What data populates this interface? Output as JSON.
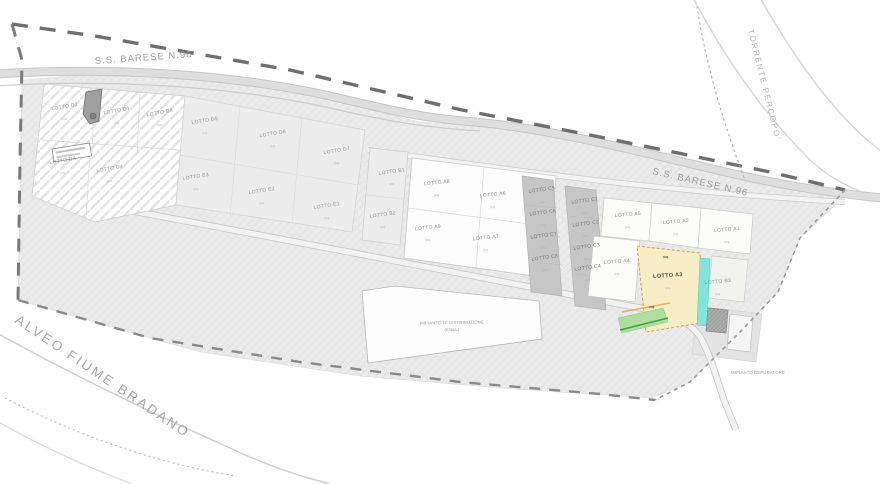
{
  "roads": {
    "ss_barese": "S.S. BARESE N.96"
  },
  "waterways": {
    "torrente": "TORRENTE PERCOPO'",
    "alveo": "ALVEO FIUME BRADANO"
  },
  "facilities": {
    "distribuzione_line1": "IMPIANTO DI DISTRIBUZIONE",
    "distribuzione_line2": "(ENEL)",
    "depuratore": "IMPIANTO DEPURATORE"
  },
  "area_unit": "mq.",
  "colors": {
    "highlight_fill": "#f6edc6",
    "highlight_border": "#c9a84c",
    "teal_strip": "#82e4dc",
    "green_area": "#aede9e",
    "green_line": "#3f9e3f",
    "orange_line": "#e0b75c"
  },
  "lots": [
    {
      "label": "LOTTO D2",
      "x": 65,
      "y": 108,
      "r": -10
    },
    {
      "label": "LOTTO D1",
      "x": 117,
      "y": 112,
      "r": -10
    },
    {
      "label": "LOTTO D8",
      "x": 160,
      "y": 114,
      "r": -10
    },
    {
      "label": "LOTTO D3",
      "x": 63,
      "y": 162,
      "r": -10
    },
    {
      "label": "LOTTO D4",
      "x": 110,
      "y": 170,
      "r": -10
    },
    {
      "label": "LOTTO D5",
      "x": 205,
      "y": 122,
      "r": -9
    },
    {
      "label": "LOTTO D6",
      "x": 273,
      "y": 135,
      "r": -9
    },
    {
      "label": "LOTTO D7",
      "x": 337,
      "y": 152,
      "r": -9
    },
    {
      "label": "LOTTO E3",
      "x": 196,
      "y": 178,
      "r": -9
    },
    {
      "label": "LOTTO E2",
      "x": 262,
      "y": 192,
      "r": -9
    },
    {
      "label": "LOTTO E1",
      "x": 327,
      "y": 207,
      "r": -9
    },
    {
      "label": "LOTTO B1",
      "x": 392,
      "y": 173,
      "r": -8
    },
    {
      "label": "LOTTO B2",
      "x": 383,
      "y": 216,
      "r": -8
    },
    {
      "label": "LOTTO A8",
      "x": 437,
      "y": 184,
      "r": -6
    },
    {
      "label": "LOTTO A6",
      "x": 493,
      "y": 196,
      "r": -6
    },
    {
      "label": "LOTTO A9",
      "x": 428,
      "y": 229,
      "r": -6
    },
    {
      "label": "LOTTO A7",
      "x": 486,
      "y": 239,
      "r": -6
    },
    {
      "label": "LOTTO C5",
      "x": 542,
      "y": 191,
      "r": -8,
      "dark": true
    },
    {
      "label": "LOTTO C6",
      "x": 543,
      "y": 214,
      "r": -8,
      "dark": true
    },
    {
      "label": "LOTTO C7",
      "x": 544,
      "y": 237,
      "r": -8,
      "dark": true
    },
    {
      "label": "LOTTO C8",
      "x": 545,
      "y": 259,
      "r": -8,
      "dark": true
    },
    {
      "label": "LOTTO C1",
      "x": 585,
      "y": 202,
      "r": -8,
      "dark": true
    },
    {
      "label": "LOTTO C2",
      "x": 586,
      "y": 225,
      "r": -8,
      "dark": true
    },
    {
      "label": "LOTTO C3",
      "x": 587,
      "y": 248,
      "r": -8,
      "dark": true
    },
    {
      "label": "LOTTO C4",
      "x": 588,
      "y": 269,
      "r": -8,
      "dark": true
    },
    {
      "label": "LOTTO A5",
      "x": 628,
      "y": 216,
      "r": -5
    },
    {
      "label": "LOTTO A2",
      "x": 676,
      "y": 223,
      "r": -5
    },
    {
      "label": "LOTTO A1",
      "x": 727,
      "y": 231,
      "r": -5
    },
    {
      "label": "LOTTO A4",
      "x": 617,
      "y": 263,
      "r": -5
    },
    {
      "label": "LOTTO B3",
      "x": 718,
      "y": 283,
      "r": -5
    },
    {
      "label": "LOTTO A3",
      "x": 668,
      "y": 277,
      "r": -4,
      "hl": true
    }
  ]
}
